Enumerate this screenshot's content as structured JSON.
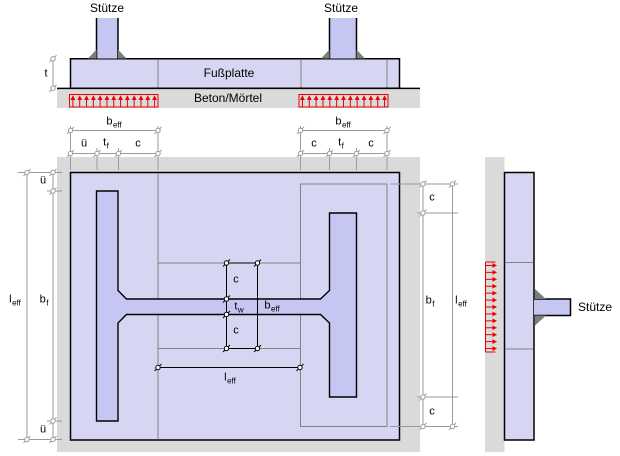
{
  "elevation": {
    "column_left_label": "Stütze",
    "column_right_label": "Stütze",
    "plate_label": "Fußplatte",
    "support_label": "Beton/Mörtel",
    "thickness_label": "t"
  },
  "plan": {
    "top_left_dims": {
      "b_eff_main": "b",
      "b_eff_sub": "eff",
      "overhang": "ü",
      "t_f_main": "t",
      "t_f_sub": "f",
      "c": "c"
    },
    "top_right_dims": {
      "b_eff_main": "b",
      "b_eff_sub": "eff",
      "c1": "c",
      "t_f_main": "t",
      "t_f_sub": "f",
      "c2": "c"
    },
    "left_dims": {
      "overhang_top": "ü",
      "b_f_main": "b",
      "b_f_sub": "f",
      "overhang_bottom": "ü",
      "l_eff_main": "l",
      "l_eff_sub": "eff"
    },
    "center_dims": {
      "c_top": "c",
      "t_w_main": "t",
      "t_w_sub": "w",
      "c_bottom": "c",
      "b_eff_main": "b",
      "b_eff_sub": "eff",
      "l_eff_main": "l",
      "l_eff_sub": "eff"
    },
    "right_dims": {
      "c_top": "c",
      "b_f_main": "b",
      "b_f_sub": "f",
      "c_bottom": "c",
      "l_eff_main": "l",
      "l_eff_sub": "eff"
    }
  },
  "side": {
    "column_label": "Stütze"
  },
  "colors": {
    "plate_fill": "#d6d6f3",
    "section_fill": "#c6c6f2",
    "concrete_fill": "#dadada",
    "weld_fill": "#7d7d7d",
    "outline": "#000000",
    "zone_line": "#838383",
    "dim_line": "#9a9a9a",
    "pressure_red": "#ee0000"
  }
}
